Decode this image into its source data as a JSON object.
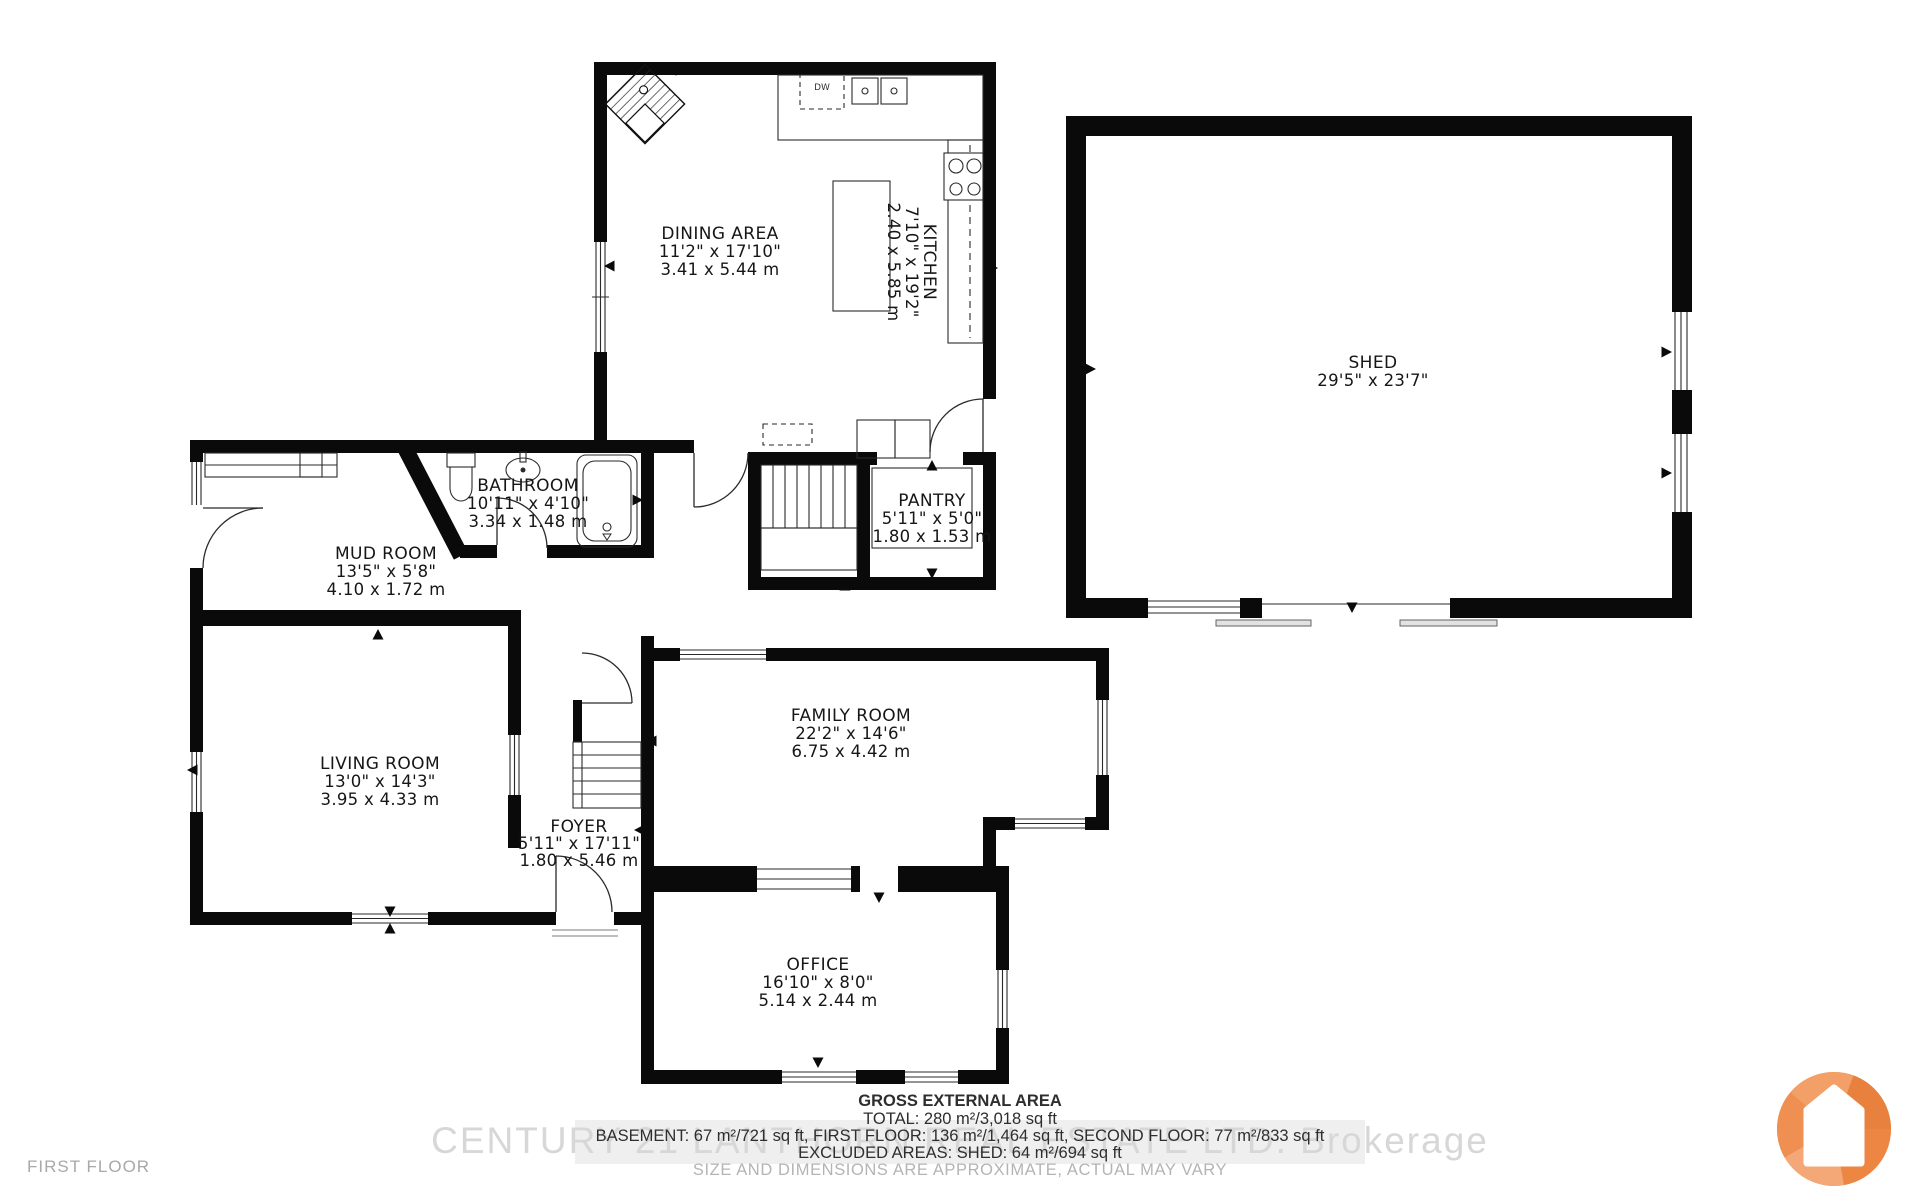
{
  "floor_label": "FIRST FLOOR",
  "rooms": {
    "dining": {
      "name": "DINING AREA",
      "imperial": "11'2\" x 17'10\"",
      "metric": "3.41 x 5.44 m"
    },
    "kitchen": {
      "name": "KITCHEN",
      "imperial": "7'10\" x 19'2\"",
      "metric": "2.40 x 5.85 m"
    },
    "shed": {
      "name": "SHED",
      "imperial": "29'5\" x 23'7\""
    },
    "bathroom": {
      "name": "BATHROOM",
      "imperial": "10'11\" x 4'10\"",
      "metric": "3.34 x 1.48 m"
    },
    "mud_room": {
      "name": "MUD ROOM",
      "imperial": "13'5\" x 5'8\"",
      "metric": "4.10 x 1.72 m"
    },
    "pantry": {
      "name": "PANTRY",
      "imperial": "5'11\" x 5'0\"",
      "metric": "1.80 x 1.53 m"
    },
    "living": {
      "name": "LIVING ROOM",
      "imperial": "13'0\" x 14'3\"",
      "metric": "3.95 x 4.33 m"
    },
    "foyer": {
      "name": "FOYER",
      "imperial": "5'11\" x 17'11\"",
      "metric": "1.80 x 5.46 m"
    },
    "family": {
      "name": "FAMILY ROOM",
      "imperial": "22'2\" x 14'6\"",
      "metric": "6.75 x 4.42 m"
    },
    "office": {
      "name": "OFFICE",
      "imperial": "16'10\" x 8'0\"",
      "metric": "5.14 x 2.44 m"
    }
  },
  "appliances": {
    "dishwasher": "DW"
  },
  "footer": {
    "gross_title": "GROSS EXTERNAL AREA",
    "total": "TOTAL: 280 m²/3,018 sq ft",
    "floors": "BASEMENT: 67 m²/721 sq ft, FIRST FLOOR: 136 m²/1,464 sq ft, SECOND FLOOR: 77 m²/833 sq ft",
    "excluded": "EXCLUDED AREAS: SHED: 64 m²/694 sq ft",
    "disclaimer": "SIZE AND DIMENSIONS ARE APPROXIMATE, ACTUAL MAY VARY"
  },
  "watermark": "CENTURY 21 LANTHORN REAL ESTATE LTD. Brokerage",
  "colors": {
    "walls": "#0a0a0a",
    "logo_orange": "#EE8A4D",
    "muted_text": "#a8a8a8",
    "watermark_grey": "#d7d7d7"
  }
}
